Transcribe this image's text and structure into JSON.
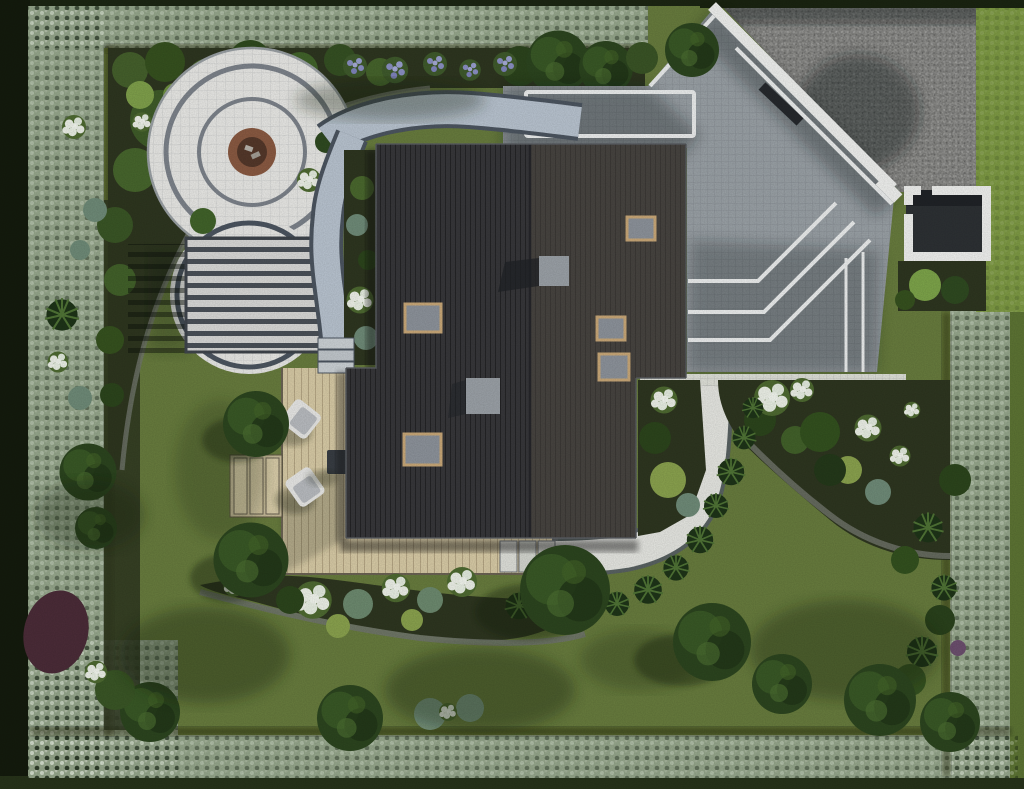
{
  "meta": {
    "title": "Aerial landscape design render",
    "subtitle": "Top-down 3D visualization of a residential garden site plan"
  },
  "features": {
    "site": "Garden site plan — aerial render",
    "lawn": "Lawn",
    "hedge": "Perimeter hedge",
    "street": "Gravel street entrance",
    "wall": "White boundary wall",
    "driveway": "Paved driveway with white inlay lines",
    "enclosure": "White bin enclosure",
    "house": "House roof with skylights",
    "fire_pit": "Circular fire-pit patio",
    "pergola": "Pergola on circular patio",
    "paths": "Paver garden paths",
    "white_path": "Curved white garden path",
    "deck": "Wooden deck terrace with lounge chairs",
    "beds": "Planting beds with hydrangeas and grasses",
    "trees": "Garden trees"
  },
  "palette": {
    "surround": "#1c2613",
    "lawn": "#687c3e",
    "grass_verge": "#7e9a44",
    "hedge": "#96a78c",
    "soil": "#2e3620",
    "foliage_dark": "#2c451f",
    "foliage_mid": "#41632a",
    "foliage_light": "#7fa04b",
    "foliage_teal": "#6f8b78",
    "flower_white": "#edf1e8",
    "flower_purple": "#8b90c4",
    "shrub_burgundy": "#4b2c38",
    "patio": "#e9e9e6",
    "patio_ring": "#7d838b",
    "firepit_rim": "#8a5a42",
    "firepit_bowl": "#54382a",
    "pergola_slat": "#d9d9d7",
    "pergola_gap": "#4b5158",
    "path": "#b9c4d0",
    "path_edge": "#4c5560",
    "white_path": "#e6e7e2",
    "deck": "#d8cba6",
    "roof_left": "#37373a",
    "roof_right": "#474440",
    "roof_ridge": "#26262a",
    "chimney": "#9ba1a7",
    "skylight_frame": "#c9a878",
    "skylight_glass": "#8d939b",
    "driveway": "#9aa1a6",
    "driveway_line": "#eceeee",
    "gravel": "#a6a6a3",
    "wall": "#f0f1ef",
    "gate": "#26292d",
    "furniture": "#e8e8e6",
    "cushion": "#b9bcc0",
    "table": "#383d43",
    "step_stone": "#ccd2d6"
  }
}
